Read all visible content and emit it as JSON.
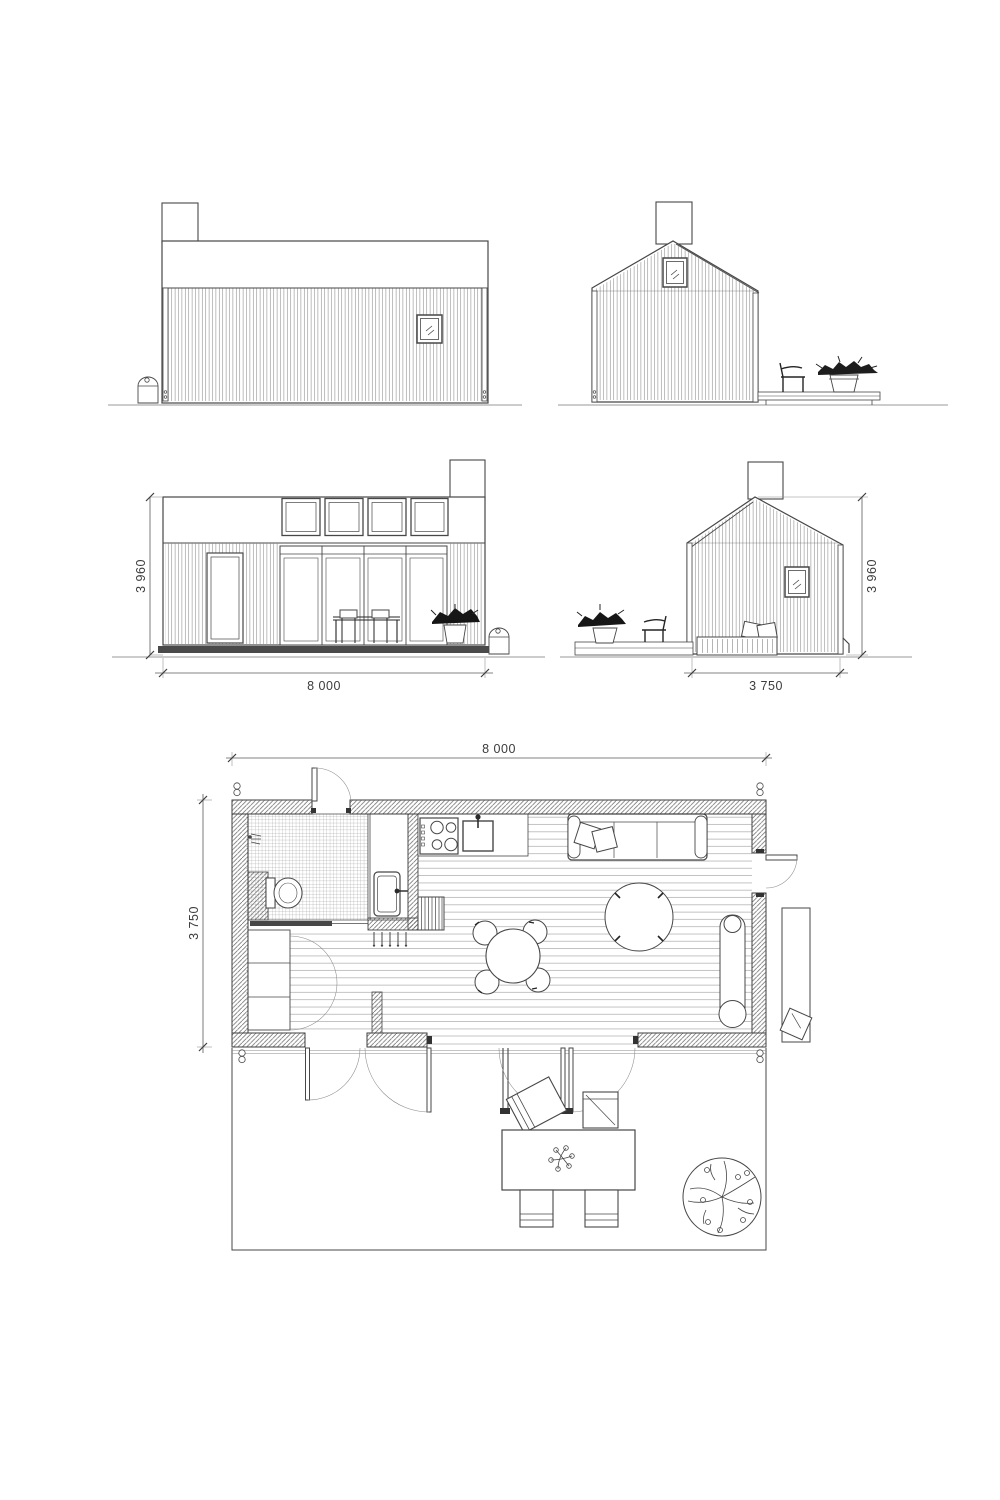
{
  "palette": {
    "ink": "#454545",
    "muted": "#8a8a8a",
    "dark_fill": "#1d1d1d"
  },
  "dimensions": {
    "front": {
      "height": "3 960",
      "width": "8 000"
    },
    "side": {
      "height": "3 960",
      "width": "3 750"
    },
    "plan": {
      "width": "8 000",
      "depth": "3 750"
    }
  }
}
